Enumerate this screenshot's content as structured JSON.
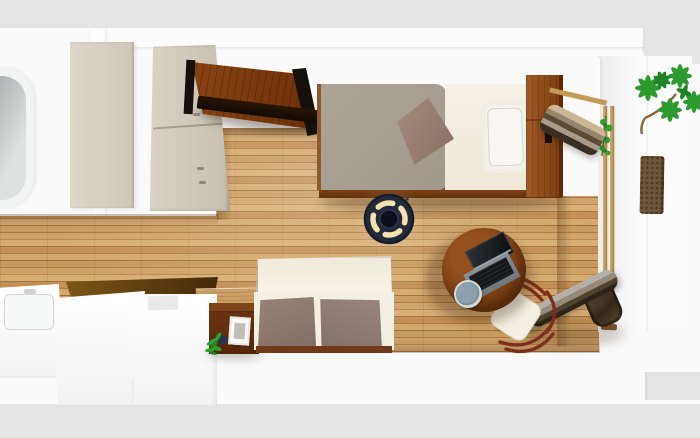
{
  "scene": {
    "title": "3D floor plan - studio apartment top view",
    "room_type": "studio apartment with kitchenette, bathroom and balcony"
  },
  "palette": {
    "background_gray": "#e4e4e5",
    "wall_white": "#fafafa",
    "floor_wood_mid": "#c08d52",
    "furniture_wood_dark": "#6b2f08",
    "furniture_wood_red": "#7a3d12",
    "headboard_brown": "#8a4a1c",
    "door_beige": "#d6cfc2",
    "wardrobe_beige": "#d2cabc",
    "duvet_taupe": "#a9a095",
    "sheet_cream": "#f4f0e4",
    "cushion_taupe": "#8d7a70",
    "sofa_cream": "#f3efe2",
    "lamp_navy": "#232a3a",
    "lamp_glow": "#f4e3ae",
    "plant_green": "#2c9a2e",
    "frame_tan": "#c9a15e",
    "chair_frame_red": "#7e2f1b",
    "laptop_slate": "#787f85",
    "mug_blue_gray": "#8da0ad",
    "countertop_brown": "#5a3a0e",
    "tub_gray": "#b9bcbd",
    "wicker_brown": "#6f5539",
    "pot_navy": "#27364a"
  },
  "objects": {
    "bathtub": {
      "label": "bathtub"
    },
    "bathroom_door": {
      "label": "bathroom sliding door"
    },
    "wardrobe": {
      "label": "wardrobe cabinet"
    },
    "wall_rack": {
      "label": "wall-mounted wooden rack"
    },
    "bed": {
      "label": "single bed with taupe duvet"
    },
    "bed_pillow": {
      "label": "bed pillow"
    },
    "bed_throw_pillow": {
      "label": "throw pillow"
    },
    "bed_headboard": {
      "label": "wooden headboard shelf"
    },
    "ceiling_light": {
      "label": "round ceiling light"
    },
    "round_table": {
      "label": "round wooden table"
    },
    "laptop": {
      "label": "open laptop"
    },
    "mug": {
      "label": "mug"
    },
    "desk_chair": {
      "label": "wooden chair"
    },
    "rolled_futon_upper": {
      "label": "rolled futon mattress"
    },
    "rolled_futon_lower": {
      "label": "rolled futon by ladder frame"
    },
    "ladder_frame": {
      "label": "wooden ladder frame"
    },
    "potted_plant_large": {
      "label": "large potted plant"
    },
    "plant_vine": {
      "label": "vine plant on frame"
    },
    "wicker_pouf": {
      "label": "wicker mat"
    },
    "sofa": {
      "label": "two-seat sofa with taupe cushions"
    },
    "side_table": {
      "label": "dark wood side table"
    },
    "photo_frame": {
      "label": "photo frame"
    },
    "side_table_plant": {
      "label": "small potted plant"
    },
    "kitchen_sink": {
      "label": "kitchen sink unit"
    },
    "kitchen_counter": {
      "label": "kitchen counter walls"
    },
    "countertop": {
      "label": "dark wood countertop"
    },
    "wood_floor": {
      "label": "oak plank flooring"
    },
    "walls": {
      "label": "white walls"
    }
  }
}
